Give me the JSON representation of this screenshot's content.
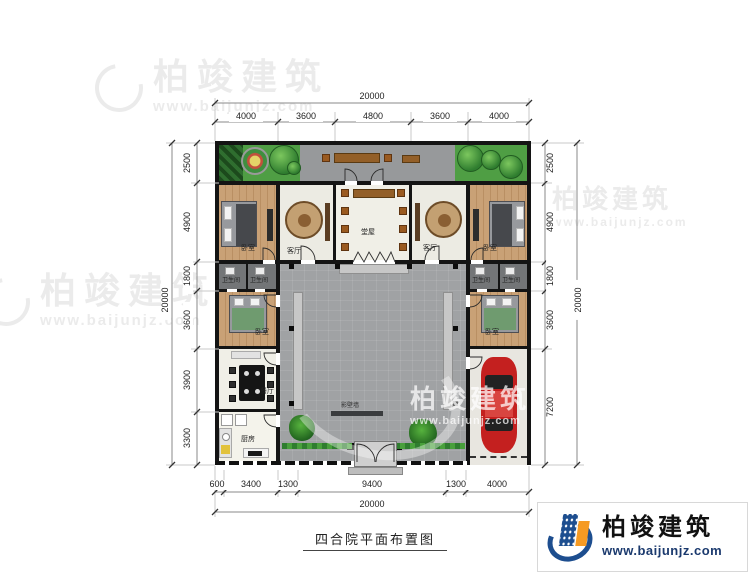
{
  "title": "四合院平面布置图",
  "brand": {
    "name": "柏竣建筑",
    "url": "www.baijunjz.com"
  },
  "dimensions": {
    "top": {
      "total": "20000",
      "segments": [
        "4000",
        "3600",
        "4800",
        "3600",
        "4000"
      ]
    },
    "bottom": {
      "total": "20000",
      "segments": [
        "600",
        "3400",
        "1300",
        "9400",
        "1300",
        "4000"
      ]
    },
    "left": {
      "total": "20000",
      "segments": [
        "2500",
        "4900",
        "1800",
        "3600",
        "3900",
        "3300"
      ]
    },
    "right": {
      "total": "20000",
      "segments": [
        "2500",
        "4900",
        "1800",
        "3600",
        "7200"
      ]
    }
  },
  "rooms": {
    "bedroom_top_left": "卧室",
    "living_left": "客厅",
    "main_hall": "堂屋",
    "living_right": "客厅",
    "bedroom_top_right": "卧室",
    "bath_1": "卫生间",
    "bath_2": "卫生间",
    "bath_3": "卫生间",
    "bath_4": "卫生间",
    "bedroom_mid_left": "卧室",
    "bedroom_mid_right": "卧室",
    "dining": "餐厅",
    "kitchen": "厨房",
    "screen_wall": "影壁墙"
  },
  "colors": {
    "wall": "#141414",
    "garden_green": "#4f9e44",
    "courtyard_gray": "#a0a2a4",
    "wood_floor": "#c9a176",
    "logo_blue": "#1d4e8f",
    "logo_orange": "#f59a23",
    "car_red": "#c4201f"
  }
}
